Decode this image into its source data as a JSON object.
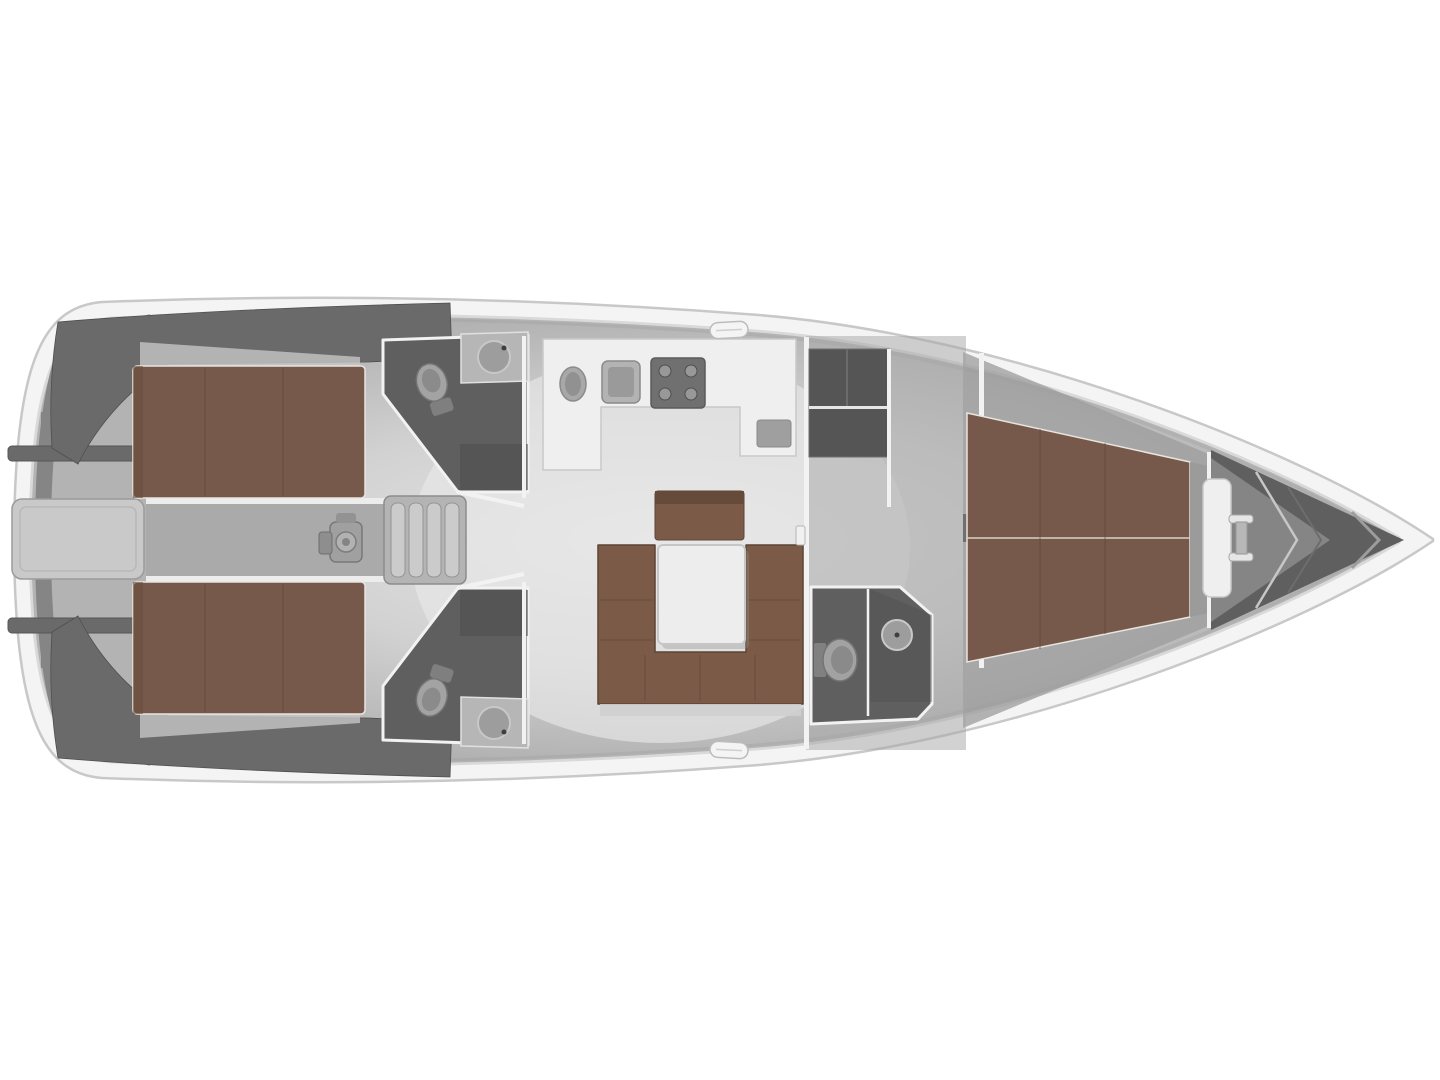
{
  "meta": {
    "title": "Sailing yacht interior layout plan, top view, bow pointing right",
    "figure_type": "boat-deck-plan",
    "orientation": "bow-right"
  },
  "colors": {
    "background": "#ffffff",
    "hull_line": "#c8c8c8",
    "deck_band": "#f4f4f4",
    "floor_edge": "#a9a9a9",
    "floor_mid": "#9c9c9c",
    "cockpit_floor": "#aaaaaa",
    "stern_gray": "#b3b3b3",
    "platform_gray": "#c9c9c9",
    "wedge_gray": "#6a6a6a",
    "structure_dark": "#5f5f5f",
    "structure_darkest": "#555555",
    "shower_dark": "#4d4d4d",
    "wall": "#f2f2f2",
    "berth_brown": "#76594a",
    "sofa_brown": "#7b5a47",
    "wood_dark_trim": "#5d4435",
    "furniture_white": "#efefef",
    "table_white": "#ededed",
    "step_gray": "#cbcbcb",
    "fixture_gray": "#9d9d9d",
    "fixture_rim": "#c8c8c8",
    "counter_gray": "#b6b6b6",
    "appliance_dark": "#707070",
    "rib_light": "#c7c7c7",
    "bow_wedge": "#858585"
  },
  "areas": {
    "swim_platform": "stern swim platform locker",
    "cockpit": "cockpit with helm pedestal and companionway steps",
    "aft_cabin_port": "aft double cabin berth (top)",
    "aft_cabin_starboard": "aft double cabin berth (bottom)",
    "aft_head_port": "aft bathroom with toilet and washbasin (top)",
    "aft_head_starboard": "aft bathroom with toilet and washbasin (bottom)",
    "galley": "galley with oval sink, square sink and stove",
    "salon": "salon with U-shaped sofa, table and bench seat",
    "wardrobe": "wardrobe and storage lockers",
    "forward_head": "forward bathroom with toilet, washbasin and shower",
    "forward_cabin": "forward V-berth double cabin",
    "anchor_locker": "bow anchor locker with windlass"
  }
}
